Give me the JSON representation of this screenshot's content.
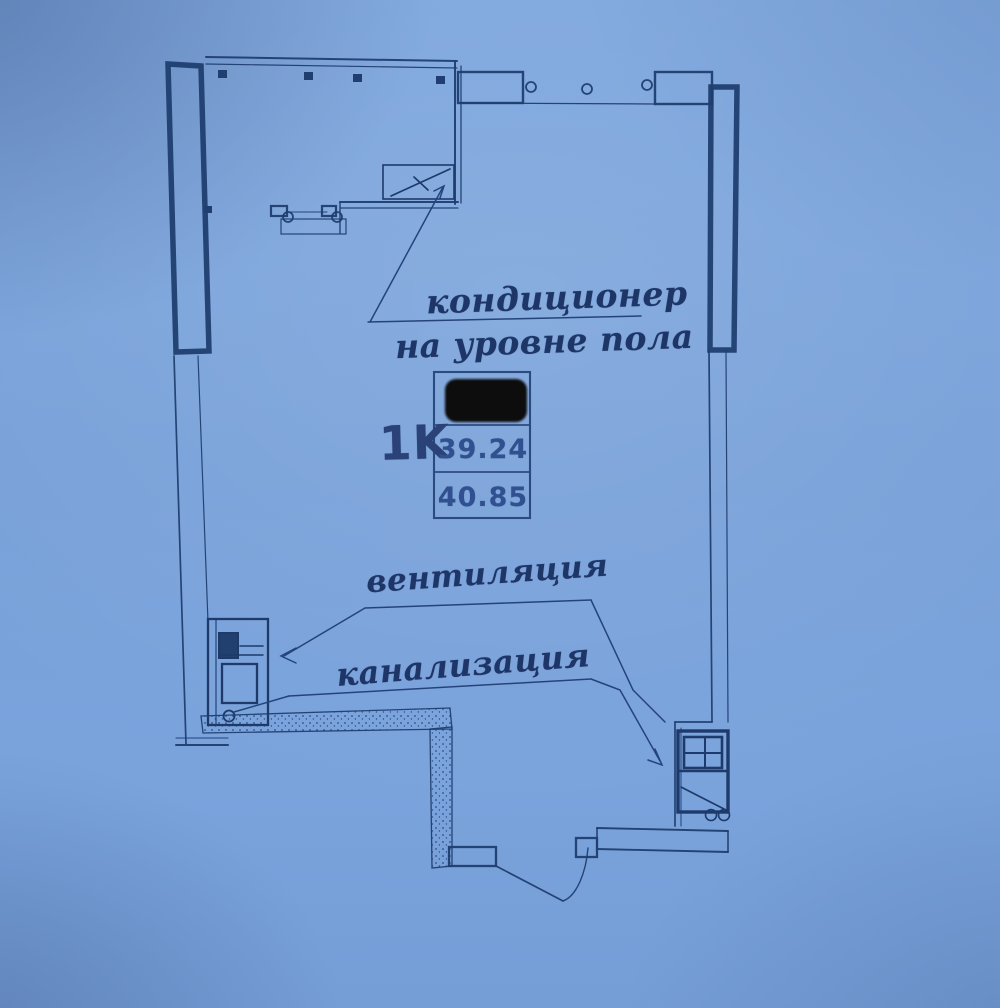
{
  "photo": {
    "paper_color": "#7aa2da",
    "ink_color": "#1e3a6c",
    "description": "photographed blueprint floor plan on blue paper"
  },
  "plan": {
    "unit_type": "1K",
    "areas": {
      "living": "39.24",
      "total": "40.85"
    },
    "labels": {
      "ac_line1": "кондиционер",
      "ac_line2": "на уровне пола",
      "ventilation": "вентиляция",
      "sewerage": "канализация"
    },
    "redaction": {
      "present": true,
      "color": "#0a0a10"
    }
  }
}
